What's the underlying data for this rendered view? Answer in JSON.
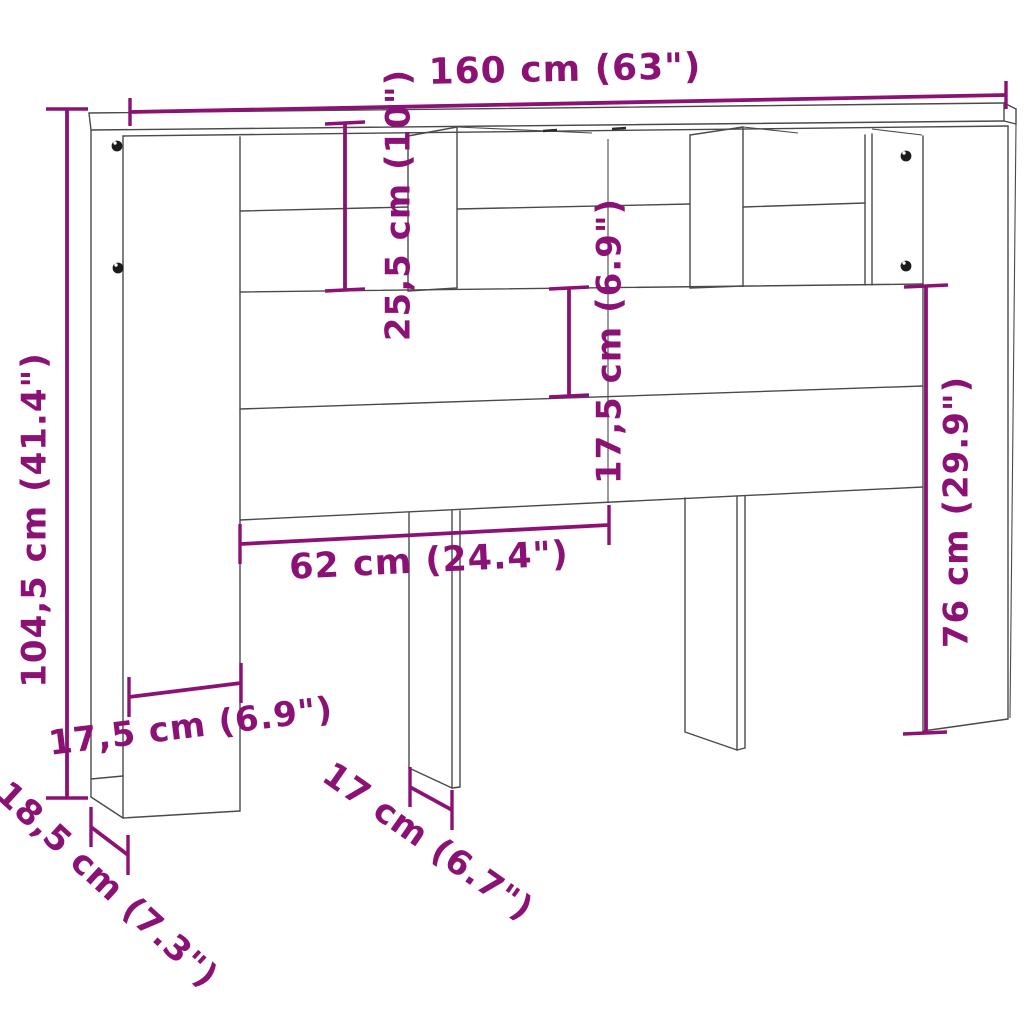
{
  "diagram": {
    "kind": "furniture-dimension-drawing",
    "colors": {
      "dimension": "#8b1274",
      "line_art": "#4a4a4a",
      "background": "#ffffff"
    },
    "dimensions": {
      "overall_width": "160 cm (63\")",
      "overall_height": "104,5 cm (41.4\")",
      "top_compartment_height": "25,5 cm (10\")",
      "rail_height": "17,5 cm (6.9\")",
      "inner_span": "62 cm (24.4\")",
      "lower_section_height": "76 cm (29.9\")",
      "pillar_width": "17,5 cm (6.9\")",
      "depth": "18,5 cm (7.3\")",
      "leg_width": "17 cm (6.7\")"
    }
  }
}
